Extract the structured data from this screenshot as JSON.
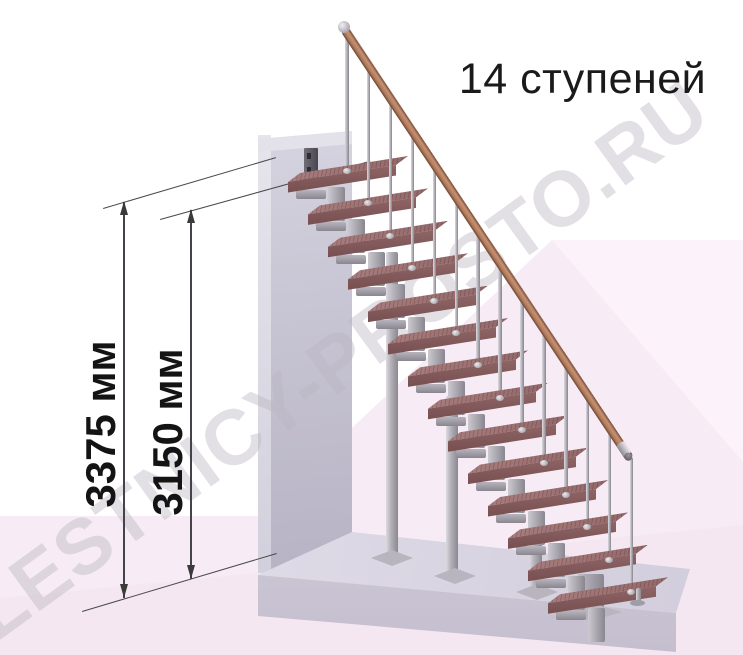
{
  "title": "14 ступеней",
  "watermark": "LESTNICY-PROSTO.RU",
  "stairs": {
    "step_count": 14,
    "step_label": "ступеней"
  },
  "dimensions": [
    {
      "id": "floor-to-floor-height",
      "label": "3375 мм",
      "value": 3375,
      "unit": "мм"
    },
    {
      "id": "floor-to-top-tread-height",
      "label": "3150 мм",
      "value": 3150,
      "unit": "мм"
    }
  ],
  "colors": {
    "tread_top": "#9b6f70",
    "tread_front": "#7c5253",
    "metal_gray": "#a19ea6",
    "handrail_copper": "#b07c5e",
    "wall_gray": "#c6c3d2",
    "floor_slab": "#d8d4e1",
    "background_tint": "#f7ecf5",
    "dimension_ink": "#3a3a3a",
    "watermark_gray": "#bab5bf",
    "text_ink": "#1a1a1a"
  }
}
